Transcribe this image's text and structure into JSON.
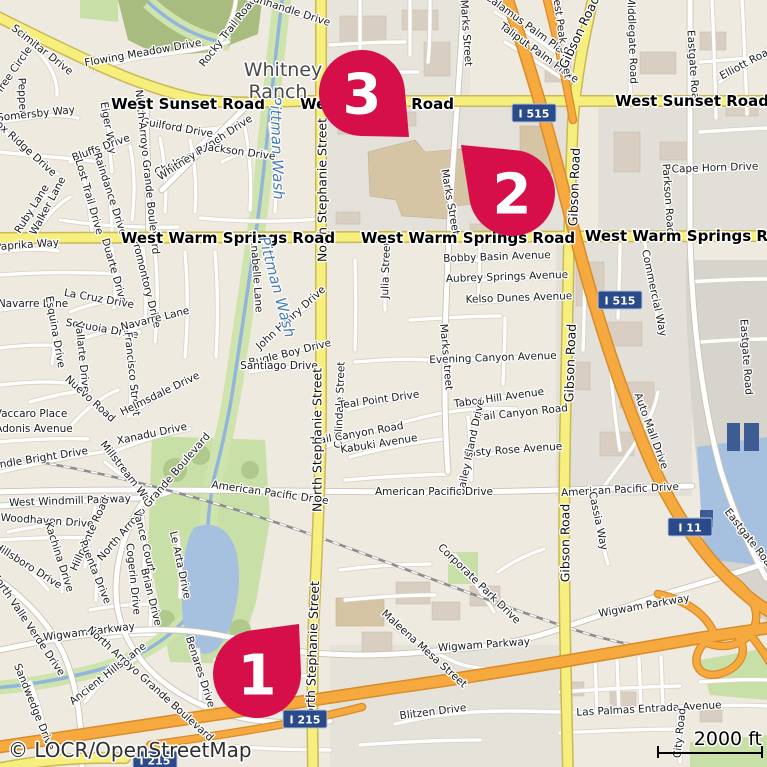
{
  "map": {
    "attribution": "© LOCR/OpenStreetMap",
    "scale_bar": {
      "label": "2000 ft"
    },
    "colors": {
      "marker": "#d60e4a",
      "major_road": "#f6ef7e",
      "motorway": "#f5a93e",
      "shield_bg": "#2a4a8a",
      "water": "#a6c0df",
      "park": "#c9dfa8",
      "forest": "#a9bc7f",
      "residential": "#eeeadf"
    },
    "place_labels": [
      {
        "t": "Whitney",
        "x": 283,
        "y": 70
      },
      {
        "t": "Ranch",
        "x": 278,
        "y": 92
      }
    ],
    "water_labels": [
      {
        "t": "Pittman Wash",
        "x": 277,
        "y": 148,
        "r": 88
      },
      {
        "t": "Pittman Wash",
        "x": 277,
        "y": 287,
        "r": 75
      }
    ],
    "major_road_labels": [
      {
        "t": "West Sunset Road",
        "x": 188,
        "y": 104,
        "r": 0
      },
      {
        "t": "West Sunset Road",
        "x": 377,
        "y": 104,
        "r": 0
      },
      {
        "t": "West Sunset Road",
        "x": 692,
        "y": 101,
        "r": 0
      },
      {
        "t": "West Warm Springs Road",
        "x": 228,
        "y": 238,
        "r": 0
      },
      {
        "t": "West Warm Springs Road",
        "x": 468,
        "y": 238,
        "r": 0
      },
      {
        "t": "West Warm Springs Road",
        "x": 692,
        "y": 236,
        "r": 0
      }
    ],
    "road_labels": [
      {
        "t": "North Stephanie Street",
        "x": 322,
        "y": 190,
        "r": -90
      },
      {
        "t": "North Stephanie Street",
        "x": 317,
        "y": 440,
        "r": -90
      },
      {
        "t": "North Stephanie Street",
        "x": 312,
        "y": 653,
        "r": -88
      },
      {
        "t": "Gibson Road",
        "x": 579,
        "y": 32,
        "r": -65
      },
      {
        "t": "Gibson Road",
        "x": 574,
        "y": 187,
        "r": -88
      },
      {
        "t": "Gibson Road",
        "x": 570,
        "y": 363,
        "r": -88
      },
      {
        "t": "Gibson Road",
        "x": 565,
        "y": 543,
        "r": -90
      }
    ],
    "street_labels": [
      {
        "t": "Scimitar Drive",
        "x": 42,
        "y": 50,
        "r": 38
      },
      {
        "t": "Tree Circle",
        "x": 14,
        "y": 70,
        "r": -55
      },
      {
        "t": "Pepper",
        "x": 22,
        "y": 96,
        "r": 88
      },
      {
        "t": "Flowing Meadow Drive",
        "x": 143,
        "y": 53,
        "r": -10
      },
      {
        "t": "Rocky Trail Road",
        "x": 228,
        "y": 32,
        "r": -52
      },
      {
        "t": "Panhandle Drive",
        "x": 289,
        "y": 10,
        "r": 18
      },
      {
        "t": "Somersby Way",
        "x": 36,
        "y": 114,
        "r": -6
      },
      {
        "t": "Fox Ridge Drive",
        "x": 24,
        "y": 147,
        "r": 42
      },
      {
        "t": "Guilford Drive",
        "x": 177,
        "y": 128,
        "r": 10
      },
      {
        "t": "Chelsea Drive",
        "x": 188,
        "y": 157,
        "r": -27
      },
      {
        "t": "Whitney Ranch Drive",
        "x": 205,
        "y": 148,
        "r": -33
      },
      {
        "t": "Jackson Drive",
        "x": 240,
        "y": 152,
        "r": 8
      },
      {
        "t": "Eiger Way",
        "x": 108,
        "y": 128,
        "r": 80
      },
      {
        "t": "Bluffs Drive",
        "x": 101,
        "y": 148,
        "r": -20
      },
      {
        "t": "North Arroyo Grande Boulevard",
        "x": 147,
        "y": 172,
        "r": 84
      },
      {
        "t": "Ruby Lane",
        "x": 32,
        "y": 209,
        "r": -58
      },
      {
        "t": "Walker Lane",
        "x": 48,
        "y": 206,
        "r": -62
      },
      {
        "t": "Lost Trail Drive",
        "x": 89,
        "y": 197,
        "r": 74
      },
      {
        "t": "Raindance Drive",
        "x": 110,
        "y": 194,
        "r": 72
      },
      {
        "t": "Paprika Way",
        "x": 27,
        "y": 245,
        "r": -4
      },
      {
        "t": "Navarre Lane",
        "x": 33,
        "y": 304,
        "r": 0
      },
      {
        "t": "Duarte Drive",
        "x": 114,
        "y": 271,
        "r": 74
      },
      {
        "t": "Promontory Drive",
        "x": 146,
        "y": 283,
        "r": 76
      },
      {
        "t": "La Cruz Drive",
        "x": 99,
        "y": 299,
        "r": 10
      },
      {
        "t": "Sequoia Drive",
        "x": 102,
        "y": 329,
        "r": 10
      },
      {
        "t": "Navarre Lane",
        "x": 155,
        "y": 319,
        "r": -14
      },
      {
        "t": "Esquina Drive",
        "x": 55,
        "y": 332,
        "r": 80
      },
      {
        "t": "Vallarte Drive",
        "x": 82,
        "y": 357,
        "r": 84
      },
      {
        "t": "Francisco Street",
        "x": 132,
        "y": 374,
        "r": 84
      },
      {
        "t": "Nuevo Road",
        "x": 90,
        "y": 399,
        "r": 42
      },
      {
        "t": "Vaccaro Place",
        "x": 31,
        "y": 414,
        "r": 0
      },
      {
        "t": "Adonis Avenue",
        "x": 34,
        "y": 429,
        "r": 0
      },
      {
        "t": "Helmsdale Drive",
        "x": 160,
        "y": 394,
        "r": -26
      },
      {
        "t": "Xanadu Drive",
        "x": 152,
        "y": 434,
        "r": -12
      },
      {
        "t": "Candle Bright Drive",
        "x": 37,
        "y": 459,
        "r": -9
      },
      {
        "t": "Annabelle Lane",
        "x": 256,
        "y": 272,
        "r": 86
      },
      {
        "t": "John Henry Drive",
        "x": 291,
        "y": 318,
        "r": -42
      },
      {
        "t": "Bugle Boy Drive",
        "x": 290,
        "y": 353,
        "r": -14
      },
      {
        "t": "Santiago Drive",
        "x": 279,
        "y": 366,
        "r": 0
      },
      {
        "t": "Julia Street",
        "x": 386,
        "y": 270,
        "r": -88
      },
      {
        "t": "Collindale Street",
        "x": 340,
        "y": 405,
        "r": -88
      },
      {
        "t": "Teal Point Drive",
        "x": 379,
        "y": 400,
        "r": -8
      },
      {
        "t": "Trail Canyon Road",
        "x": 357,
        "y": 434,
        "r": -10
      },
      {
        "t": "Kabuki Avenue",
        "x": 379,
        "y": 444,
        "r": -9
      },
      {
        "t": "Marks Street",
        "x": 466,
        "y": 33,
        "r": 86
      },
      {
        "t": "Marks Street",
        "x": 450,
        "y": 202,
        "r": 80
      },
      {
        "t": "Marks Street",
        "x": 446,
        "y": 357,
        "r": 85
      },
      {
        "t": "Bobby Basin Avenue",
        "x": 497,
        "y": 257,
        "r": -2
      },
      {
        "t": "Aubrey Springs Avenue",
        "x": 507,
        "y": 277,
        "r": -2
      },
      {
        "t": "Kelso Dunes Avenue",
        "x": 519,
        "y": 298,
        "r": -2
      },
      {
        "t": "Evening Canyon Avenue",
        "x": 493,
        "y": 358,
        "r": -2
      },
      {
        "t": "Tabor Hill Avenue",
        "x": 499,
        "y": 398,
        "r": -8
      },
      {
        "t": "Trail Canyon Road",
        "x": 521,
        "y": 413,
        "r": -6
      },
      {
        "t": "Misty Rose Avenue",
        "x": 513,
        "y": 450,
        "r": -4
      },
      {
        "t": "Bailey Island Drive",
        "x": 471,
        "y": 447,
        "r": -78
      },
      {
        "t": "Corporate Park Drive",
        "x": 479,
        "y": 584,
        "r": 44
      },
      {
        "t": "Calamus Palm Place",
        "x": 529,
        "y": 27,
        "r": 36
      },
      {
        "t": "Taliput Palm Place",
        "x": 539,
        "y": 53,
        "r": 36
      },
      {
        "t": "Forest Peak Street",
        "x": 561,
        "y": 31,
        "r": 82
      },
      {
        "t": "Middlegate Road",
        "x": 632,
        "y": 40,
        "r": 88
      },
      {
        "t": "Eastgate Road",
        "x": 693,
        "y": 68,
        "r": 86
      },
      {
        "t": "Elliott Road",
        "x": 747,
        "y": 63,
        "r": -28
      },
      {
        "t": "Cape Horn Drive",
        "x": 715,
        "y": 168,
        "r": -2
      },
      {
        "t": "Parkson Road",
        "x": 668,
        "y": 199,
        "r": 86
      },
      {
        "t": "Eastgate Road",
        "x": 746,
        "y": 357,
        "r": 86
      },
      {
        "t": "Eastgate Road",
        "x": 750,
        "y": 540,
        "r": 52
      },
      {
        "t": "Commercial Way",
        "x": 654,
        "y": 293,
        "r": 78
      },
      {
        "t": "Auto Mall Drive",
        "x": 651,
        "y": 431,
        "r": 70
      },
      {
        "t": "American Pacific Drive",
        "x": 270,
        "y": 493,
        "r": 8
      },
      {
        "t": "American Pacific Drive",
        "x": 434,
        "y": 492,
        "r": 0
      },
      {
        "t": "American Pacific Drive",
        "x": 620,
        "y": 490,
        "r": -3
      },
      {
        "t": "West Windmill Parkway",
        "x": 70,
        "y": 501,
        "r": -2
      },
      {
        "t": "Woodhaven Drive",
        "x": 47,
        "y": 521,
        "r": 4
      },
      {
        "t": "Hillsboro Drive",
        "x": 28,
        "y": 566,
        "r": 32
      },
      {
        "t": "Kachina Drive",
        "x": 59,
        "y": 557,
        "r": 72
      },
      {
        "t": "Hillpointe Road",
        "x": 90,
        "y": 534,
        "r": -66
      },
      {
        "t": "Puenta Drive",
        "x": 95,
        "y": 572,
        "r": 68
      },
      {
        "t": "Millstream Way",
        "x": 127,
        "y": 474,
        "r": 52
      },
      {
        "t": "North Arroyo Grande Boulevard",
        "x": 154,
        "y": 497,
        "r": -49
      },
      {
        "t": "Vance Court",
        "x": 144,
        "y": 541,
        "r": 76
      },
      {
        "t": "Cogerin Drive",
        "x": 133,
        "y": 579,
        "r": 84
      },
      {
        "t": "Brian Drive",
        "x": 151,
        "y": 597,
        "r": 76
      },
      {
        "t": "Le Arta Drive",
        "x": 180,
        "y": 565,
        "r": 78
      },
      {
        "t": "Wigwam Parkway",
        "x": 89,
        "y": 632,
        "r": -7
      },
      {
        "t": "Wigwam Parkway",
        "x": 484,
        "y": 645,
        "r": -4
      },
      {
        "t": "Wigwam Parkway",
        "x": 644,
        "y": 606,
        "r": -10
      },
      {
        "t": "North Valle Verde Drive",
        "x": 28,
        "y": 624,
        "r": 56
      },
      {
        "t": "Sandwedge Drive",
        "x": 34,
        "y": 707,
        "r": 68
      },
      {
        "t": "Ancient Hills Lane",
        "x": 108,
        "y": 674,
        "r": -38
      },
      {
        "t": "Benares Drive",
        "x": 200,
        "y": 672,
        "r": 72
      },
      {
        "t": "North Arroyo Grande Boulevard",
        "x": 150,
        "y": 684,
        "r": 42
      },
      {
        "t": "Maleena Mesa Street",
        "x": 424,
        "y": 649,
        "r": 42
      },
      {
        "t": "Blitzen Drive",
        "x": 433,
        "y": 712,
        "r": -7
      },
      {
        "t": "Las Palmas Entrada Avenue",
        "x": 649,
        "y": 709,
        "r": -3
      },
      {
        "t": "City Road",
        "x": 680,
        "y": 733,
        "r": -84
      },
      {
        "t": "Cassia Way",
        "x": 598,
        "y": 521,
        "r": 78
      }
    ],
    "shields": [
      {
        "text": "I 515",
        "x": 534,
        "y": 113
      },
      {
        "text": "I 515",
        "x": 620,
        "y": 300
      },
      {
        "text": "I 11",
        "x": 690,
        "y": 527
      },
      {
        "text": "I 215",
        "x": 305,
        "y": 719
      },
      {
        "text": "I 215",
        "x": 155,
        "y": 760
      }
    ],
    "markers": [
      {
        "label": "3",
        "cx": 362,
        "cy": 93,
        "rad": 43,
        "tipx": 409,
        "tipy": 137
      },
      {
        "label": "2",
        "cx": 512,
        "cy": 193,
        "rad": 43,
        "tipx": 461,
        "tipy": 145
      },
      {
        "label": "1",
        "cx": 257,
        "cy": 674,
        "rad": 44,
        "tipx": 299,
        "tipy": 624
      }
    ]
  }
}
